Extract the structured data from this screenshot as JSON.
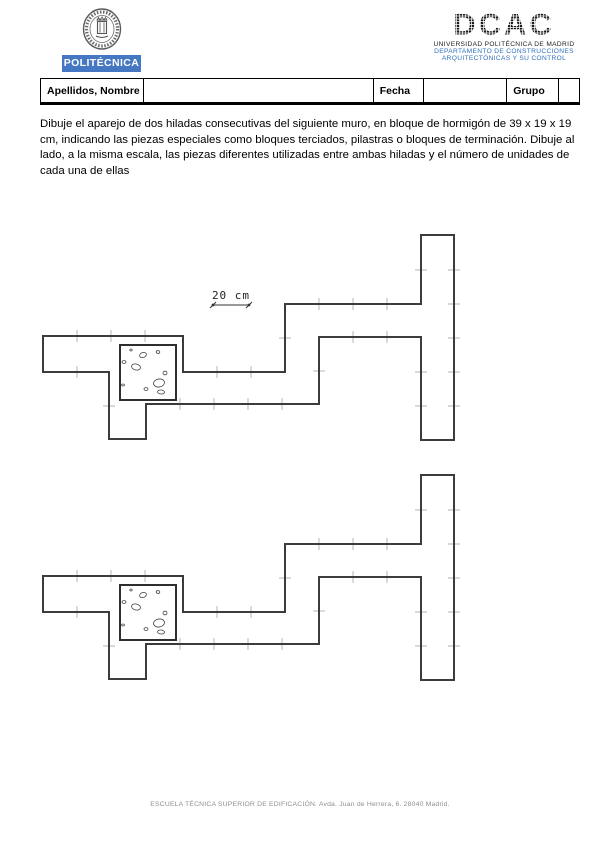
{
  "header": {
    "banner_text": "POLITÉCNICA",
    "dcac": {
      "logo_text": "DCAC",
      "line1": "UNIVERSIDAD POLITÉCNICA DE MADRID",
      "line2": "DEPARTAMENTO DE CONSTRUCCIONES",
      "line3": "ARQUITECTÓNICAS Y SU CONTROL"
    }
  },
  "form": {
    "fields": [
      {
        "label": "Apellidos, Nombre",
        "value": ""
      },
      {
        "label": "Fecha",
        "value": ""
      },
      {
        "label": "Grupo",
        "value": ""
      }
    ]
  },
  "instructions": "Dibuje el aparejo de dos hiladas consecutivas del siguiente muro, en bloque de hormigón de 39 x 19 x 19 cm, indicando las piezas especiales como bloques terciados, pilastras o bloques de terminación. Dibuje al lado, a la misma escala, las piezas diferentes utilizadas entre ambas hiladas y el número de unidades de cada una de ellas",
  "footer": "ESCUELA TÉCNICA SUPERIOR DE EDIFICACIÓN. Avda. Juan de Herrera, 6. 28040 Madrid.",
  "colors": {
    "banner_blue": "#4577c2",
    "dcac_blue": "#2e6fbe",
    "wall_outline": "#3c3c3c",
    "tick_gray": "#b5b5b5",
    "stone_stroke": "#444444",
    "footer_gray": "#8f8f8f"
  },
  "drawing": {
    "outline_points": "43,336 183,336 183,372 285,372 285,304 421,304 421,235 454,235 454,440 421,440 421,337 319,337 319,404 146,404 146,439 109,439 109,372 43,372",
    "outline_width": 2,
    "pilaster": {
      "x": 120,
      "y": 345,
      "w": 56,
      "h": 55
    },
    "stones": [
      [
        143,
        355,
        3.5,
        2.5,
        -20
      ],
      [
        158,
        352,
        1.8,
        1.4,
        10
      ],
      [
        124,
        362,
        2.0,
        1.4,
        0
      ],
      [
        136,
        367,
        4.5,
        3,
        15
      ],
      [
        165,
        373,
        2,
        1.8,
        0
      ],
      [
        159,
        383,
        5.5,
        4,
        -10
      ],
      [
        146,
        389,
        2,
        1.4,
        0
      ],
      [
        161,
        392,
        3.5,
        2,
        5
      ],
      [
        123,
        385,
        1.4,
        1,
        0
      ],
      [
        131,
        350,
        1.2,
        1,
        0
      ]
    ],
    "ticks_h": [
      {
        "y": 336,
        "xs": [
          77,
          111,
          145
        ]
      },
      {
        "y": 372,
        "xs": [
          77,
          217,
          251
        ]
      },
      {
        "y": 404,
        "xs": [
          180,
          214,
          248,
          282
        ]
      },
      {
        "y": 304,
        "xs": [
          319,
          353,
          387
        ]
      },
      {
        "y": 337,
        "xs": [
          353,
          387
        ]
      }
    ],
    "ticks_v": [
      {
        "x": 454,
        "ys": [
          270,
          304,
          338,
          372,
          406
        ]
      },
      {
        "x": 421,
        "ys": [
          270,
          372,
          406
        ]
      },
      {
        "x": 285,
        "ys": [
          338
        ]
      },
      {
        "x": 319,
        "ys": [
          371
        ]
      },
      {
        "x": 109,
        "ys": [
          406
        ]
      }
    ],
    "tick_half": 6,
    "dimension": {
      "x1": 213,
      "x2": 249,
      "y": 305,
      "label": "20 cm",
      "label_x": 231,
      "label_y": 299
    },
    "instances": [
      {
        "name": "wall-plan-upper",
        "dy": 0,
        "show_dimension": true
      },
      {
        "name": "wall-plan-lower",
        "dy": 240,
        "show_dimension": false
      }
    ]
  }
}
